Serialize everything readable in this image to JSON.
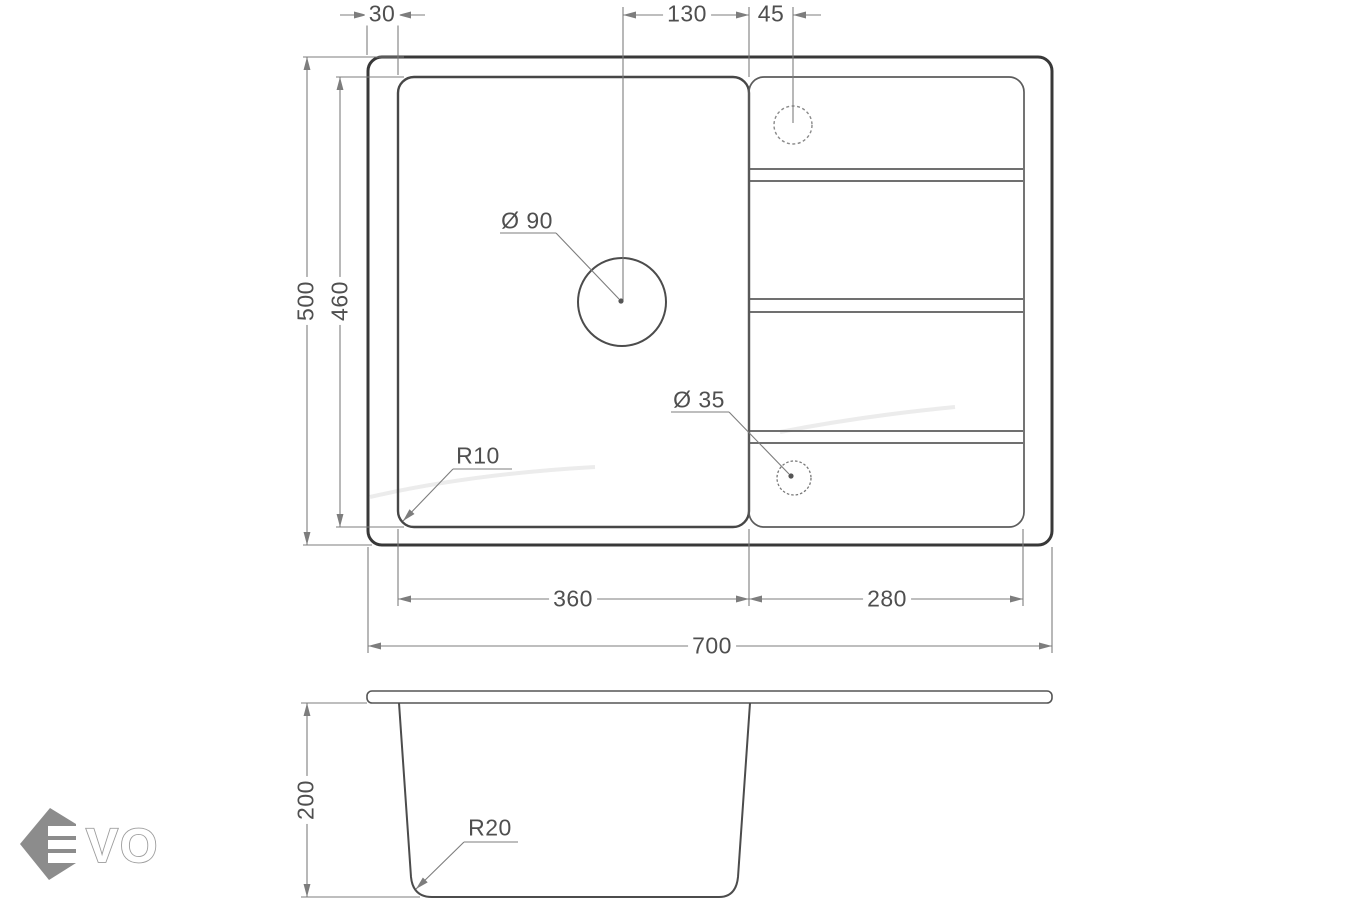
{
  "colors": {
    "line_heavy": "#383838",
    "line_mid": "#474747",
    "line_light": "#5c5c5c",
    "dimension_lines": "#7d7d7d",
    "dimension_text": "#4f4f4f",
    "logo_gray": "#8c8c8c",
    "watermark": "#ececec"
  },
  "plan_view": {
    "dims": {
      "rim_offset": "30",
      "drain_to_divider": "130",
      "divider_to_tap_hole": "45",
      "overall_depth": "500",
      "bowl_inner_depth": "460",
      "bowl_width": "360",
      "drainer_width": "280",
      "overall_width": "700",
      "drain_hole_diameter": "Ø 90",
      "tap_hole_diameter": "Ø 35",
      "corner_radius": "R10"
    }
  },
  "section_view": {
    "dims": {
      "bowl_depth": "200",
      "bottom_corner_radius": "R20"
    }
  },
  "logo": {
    "letters": "VO"
  }
}
